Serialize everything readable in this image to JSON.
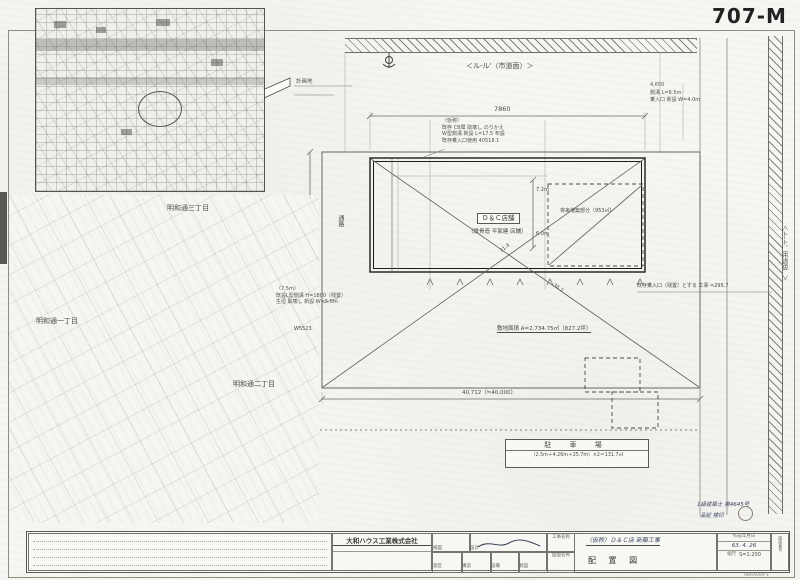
{
  "sheet": {
    "number": "707-M",
    "corner_code": "9B6A009-1"
  },
  "vicinity_map": {
    "site_flag": "計画地"
  },
  "area_map": {
    "label_3chome": "明和通三丁目",
    "label_1chome": "明和通一丁目",
    "label_2chome": "明和通二丁目"
  },
  "site_plan": {
    "top_road_label": "＜ル-ル'（市道面）＞",
    "right_road_label": "＜ト-ト'（市道B）＞",
    "top_dim": "7860",
    "top_note_1": "（仮称）",
    "top_note_2": "既存 CB塀 取壊し のりかえ",
    "top_note_3": "W型側溝 新設 L=17.5 布設",
    "top_note_4": "既存乗入口使用 40518.1",
    "right_note_1": "4,650",
    "right_note_2": "側溝 L=6.5m",
    "right_note_3": "乗入口 新設 W=4.0m",
    "right_mid_note": "既存乗入口（残置）とする 工事 ≒295.7",
    "left_note_1": "（7.5m）",
    "left_note_2": "既設L型側溝 H=1800（残置）",
    "left_note_3": "生垣 取壊し 新設 W=5.0m",
    "left_dim": "W5523",
    "aisle_label": "通路",
    "building_label": "Ｄ＆Ｃ店舗",
    "building_sub": "（鉄骨造 平家建 店舗）",
    "future_label": "将来増築部分（953㎡）",
    "inner_dim_1": "7.2m",
    "inner_dim_2": "6.0m",
    "diag_dim_1": "31.4",
    "diag_dim_2": "36.2",
    "area_note": "敷地面積 A=2,734.75㎡（827.2坪）",
    "bottom_dim": "40,712（≒40,000）",
    "parking_title": "駐 車 場",
    "parking_calc": "（2.5m＋4.26m＋25.7m）×2＝131.7㎡",
    "stamp_line_1": "1級建築士 第4645号",
    "stamp_line_2": "品証 検印"
  },
  "title_block": {
    "company": "大和ハウス工業株式会社",
    "cell_kenzu": "検図",
    "cell_sekkei": "設計",
    "cell_ishou": "意匠",
    "cell_kouzou": "構造",
    "cell_setsubi": "設備",
    "cell_seizu": "製図",
    "project_label": "工事名称",
    "project_value": "（仮称）Ｄ＆Ｃ店 新築工事",
    "drawing_label": "図面名称",
    "drawing_value": "配 置 図",
    "date_label": "作成年月日",
    "date_value": "63. 4. 26",
    "scale_label": "縮尺",
    "scale_value": "S=1:200",
    "number_label": "図面番号"
  }
}
